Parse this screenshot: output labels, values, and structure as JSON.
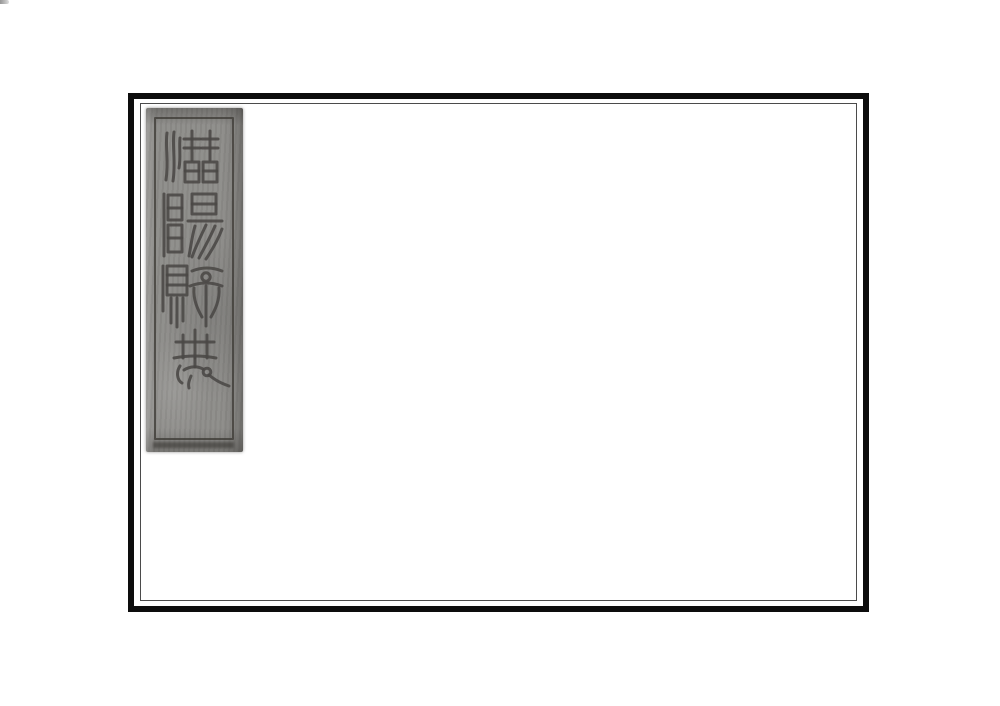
{
  "cover": {
    "title": "潛陽縣志",
    "characters": [
      "潛",
      "陽",
      "縣",
      "志"
    ],
    "colors": {
      "page_background": "#ffffff",
      "outer_frame_border": "#0d0d0d",
      "inner_frame_border": "#4b4b4b",
      "label_background": "#8d8c89",
      "label_ink": "#4a4845"
    }
  }
}
